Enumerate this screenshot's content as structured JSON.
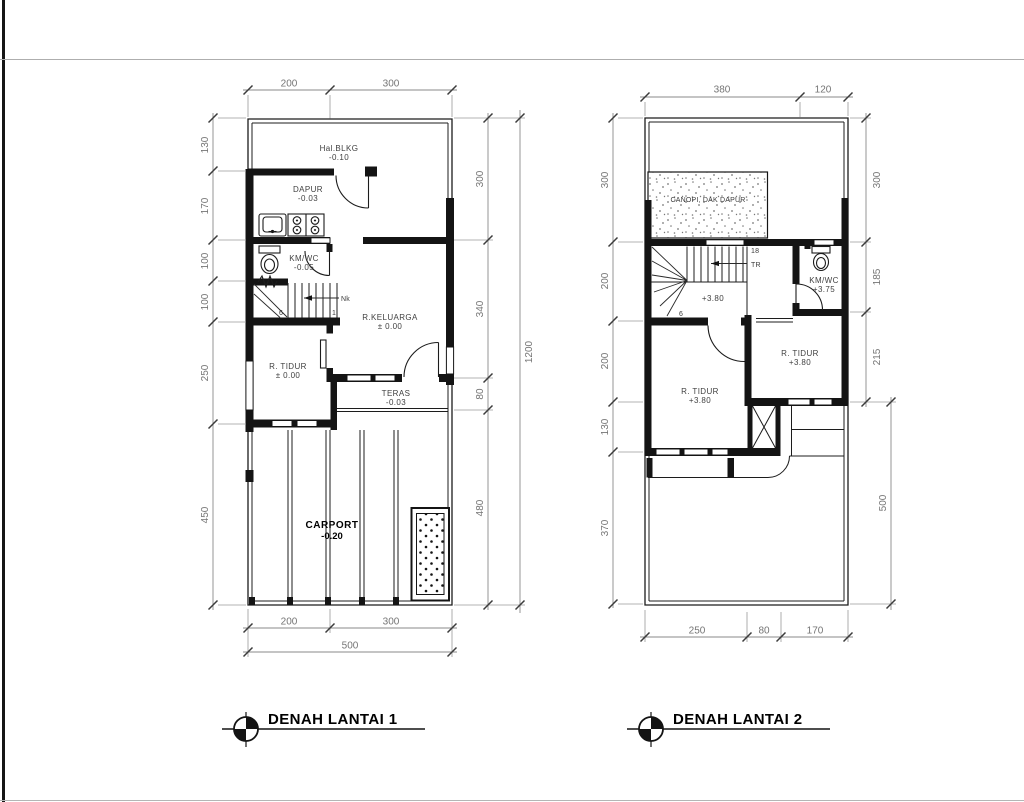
{
  "colors": {
    "line": "#141414",
    "dim_text": "#757575",
    "background": "#ffffff"
  },
  "plan1": {
    "title": "DENAH LANTAI 1",
    "rooms": {
      "hal_blkg": {
        "name": "Hal.BLKG",
        "level": "-0.10"
      },
      "dapur": {
        "name": "DAPUR",
        "level": "-0.03"
      },
      "km_wc": {
        "name": "KM/WC",
        "level": "-0.05"
      },
      "r_keluarga": {
        "name": "R.KELUARGA",
        "level": "± 0.00"
      },
      "r_tidur": {
        "name": "R. TIDUR",
        "level": "± 0.00"
      },
      "teras": {
        "name": "TERAS",
        "level": "-0.03"
      },
      "carport": {
        "name": "CARPORT",
        "level": "-0.20"
      }
    },
    "stairs": {
      "nk": "Nk",
      "first": "1",
      "last": "6"
    },
    "dims": {
      "top": [
        "200",
        "300"
      ],
      "left": [
        "130",
        "170",
        "100",
        "100",
        "250",
        "450"
      ],
      "right": [
        "300",
        "340",
        "80",
        "480"
      ],
      "right_total": "1200",
      "bottom": [
        "200",
        "300"
      ],
      "bottom_total": "500"
    }
  },
  "plan2": {
    "title": "DENAH LANTAI 2",
    "rooms": {
      "canopi": {
        "name": "CANOPI, DAK DAPUR"
      },
      "km_wc": {
        "name": "KM/WC",
        "level": "+3.75"
      },
      "r_tidur_left": {
        "name": "R. TIDUR",
        "level": "+3.80"
      },
      "r_tidur_right": {
        "name": "R. TIDUR",
        "level": "+3.80"
      },
      "landing": {
        "level": "+3.80"
      }
    },
    "stairs": {
      "count": "18",
      "tr": "TR",
      "six": "6"
    },
    "dims": {
      "top": [
        "380",
        "120"
      ],
      "left": [
        "300",
        "200",
        "200",
        "130",
        "370"
      ],
      "right": [
        "300",
        "185",
        "215"
      ],
      "right_total": "500",
      "bottom": [
        "250",
        "80",
        "170"
      ]
    }
  }
}
